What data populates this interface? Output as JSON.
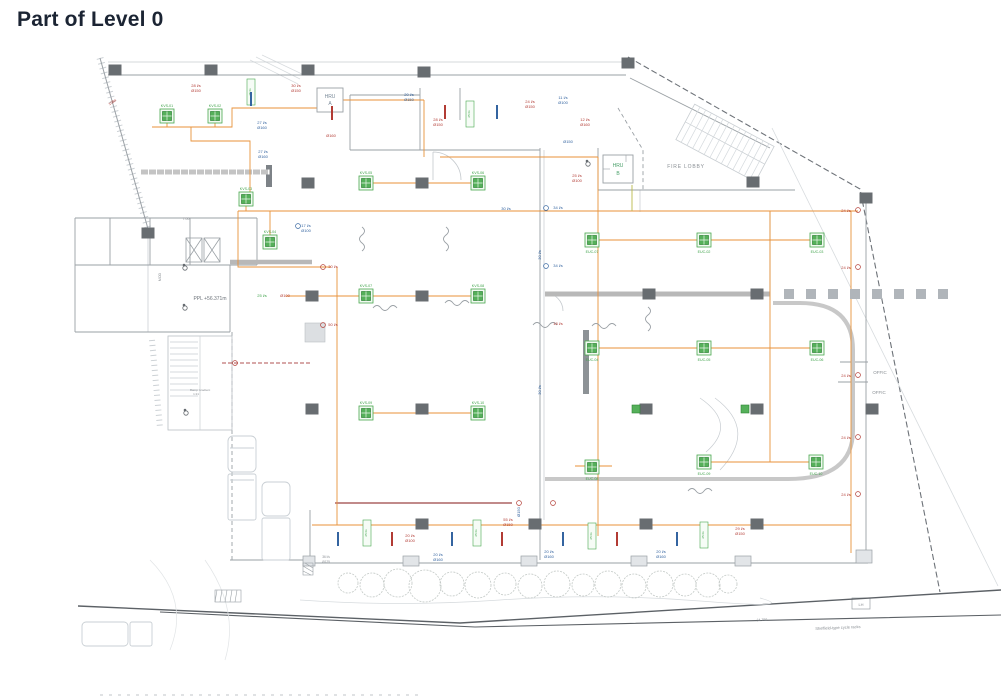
{
  "page": {
    "title": "Part of Level 0"
  },
  "colors": {
    "red": "#b23b34",
    "blue": "#3464a0",
    "green": "#3fa24a",
    "gray": "#8a8f94",
    "gray2": "#9aa0a5",
    "orange": "#e8923a",
    "hdr": "#7a8a99",
    "hdrb": "#4aa06a"
  },
  "plan": {
    "room_labels": [
      {
        "x": 330,
        "y": 98,
        "t": "HRU",
        "c": "hdr",
        "s": 5
      },
      {
        "x": 330,
        "y": 105,
        "t": "A",
        "c": "hdr",
        "s": 5
      },
      {
        "x": 618,
        "y": 167,
        "t": "HRU",
        "c": "hdrb",
        "s": 5
      },
      {
        "x": 618,
        "y": 175,
        "t": "B",
        "c": "hdrb",
        "s": 5
      },
      {
        "x": 686,
        "y": 168,
        "t": "FIRE LOBBY",
        "c": "gray",
        "s": 5,
        "ls": 0.8
      },
      {
        "x": 880,
        "y": 374,
        "t": "OFFIC",
        "c": "gray",
        "s": 4.5
      },
      {
        "x": 879,
        "y": 394,
        "t": "OFFIC",
        "c": "gray",
        "s": 4.5
      },
      {
        "x": 210,
        "y": 300,
        "t": "PPL +56.371m",
        "c": "#6d737a",
        "s": 5
      },
      {
        "x": 186,
        "y": 220,
        "t": "7.00",
        "c": "gray",
        "s": 3.5
      },
      {
        "x": 200,
        "y": 391,
        "t": "Ramp Gradient",
        "c": "gray",
        "s": 3
      },
      {
        "x": 196,
        "y": 395,
        "t": "1:21",
        "c": "gray",
        "s": 3
      },
      {
        "x": 161,
        "y": 277,
        "t": "MOD",
        "c": "gray",
        "s": 3.5,
        "r": -90
      },
      {
        "x": 762,
        "y": 621,
        "t": "34.750",
        "c": "gray",
        "s": 3.5,
        "r": -3
      },
      {
        "x": 838,
        "y": 629,
        "t": "Sheffield-type cycle racks",
        "c": "gray",
        "s": 4,
        "r": -2.5
      },
      {
        "x": 861,
        "y": 606,
        "t": "LH",
        "c": "gray",
        "s": 4
      }
    ],
    "flow_labels": [
      {
        "x": 113,
        "y": 103,
        "t": "10Ba",
        "c": "red",
        "s": 3.6,
        "r": -35
      },
      {
        "x": 196,
        "y": 87,
        "t": "28 l/s",
        "c": "red"
      },
      {
        "x": 196,
        "y": 92,
        "t": "Ø150",
        "c": "red"
      },
      {
        "x": 296,
        "y": 87,
        "t": "30 l/s",
        "c": "red"
      },
      {
        "x": 296,
        "y": 92,
        "t": "Ø150",
        "c": "red"
      },
      {
        "x": 262,
        "y": 124,
        "t": "27 l/s",
        "c": "blue"
      },
      {
        "x": 262,
        "y": 129,
        "t": "Ø160",
        "c": "blue"
      },
      {
        "x": 331,
        "y": 137,
        "t": "Ø160",
        "c": "red"
      },
      {
        "x": 263,
        "y": 153,
        "t": "27 l/s",
        "c": "blue"
      },
      {
        "x": 263,
        "y": 158,
        "t": "Ø160",
        "c": "blue"
      },
      {
        "x": 409,
        "y": 96,
        "t": "20 l/s",
        "c": "blue"
      },
      {
        "x": 409,
        "y": 101,
        "t": "Ø150",
        "c": "blue"
      },
      {
        "x": 438,
        "y": 121,
        "t": "28 l/s",
        "c": "red"
      },
      {
        "x": 438,
        "y": 126,
        "t": "Ø150",
        "c": "red"
      },
      {
        "x": 530,
        "y": 103,
        "t": "24 l/s",
        "c": "red"
      },
      {
        "x": 530,
        "y": 108,
        "t": "Ø150",
        "c": "red"
      },
      {
        "x": 563,
        "y": 99,
        "t": "11 l/s",
        "c": "blue"
      },
      {
        "x": 563,
        "y": 104,
        "t": "Ø100",
        "c": "blue"
      },
      {
        "x": 585,
        "y": 121,
        "t": "12 l/s",
        "c": "red"
      },
      {
        "x": 585,
        "y": 126,
        "t": "Ø160",
        "c": "red"
      },
      {
        "x": 568,
        "y": 143,
        "t": "Ø150",
        "c": "blue"
      },
      {
        "x": 577,
        "y": 177,
        "t": "25 l/s",
        "c": "red"
      },
      {
        "x": 577,
        "y": 182,
        "t": "Ø100",
        "c": "red"
      },
      {
        "x": 506,
        "y": 210,
        "t": "30 l/s",
        "c": "blue"
      },
      {
        "x": 558,
        "y": 209,
        "t": "34 l/s",
        "c": "blue"
      },
      {
        "x": 558,
        "y": 267,
        "t": "34 l/s",
        "c": "blue"
      },
      {
        "x": 558,
        "y": 325,
        "t": "18 l/s",
        "c": "red"
      },
      {
        "x": 306,
        "y": 227,
        "t": "17 l/s",
        "c": "blue"
      },
      {
        "x": 306,
        "y": 232,
        "t": "Ø100",
        "c": "blue"
      },
      {
        "x": 262,
        "y": 297,
        "t": "25 l/s",
        "c": "green"
      },
      {
        "x": 285,
        "y": 297,
        "t": "Ø100",
        "c": "red"
      },
      {
        "x": 333,
        "y": 268,
        "t": "30 l/s",
        "c": "red"
      },
      {
        "x": 333,
        "y": 326,
        "t": "50 l/s",
        "c": "red"
      },
      {
        "x": 846,
        "y": 212,
        "t": "24 l/s",
        "c": "red"
      },
      {
        "x": 846,
        "y": 269,
        "t": "24 l/s",
        "c": "red"
      },
      {
        "x": 846,
        "y": 377,
        "t": "24 l/s",
        "c": "red"
      },
      {
        "x": 846,
        "y": 439,
        "t": "24 l/s",
        "c": "red"
      },
      {
        "x": 846,
        "y": 496,
        "t": "24 l/s",
        "c": "red"
      },
      {
        "x": 410,
        "y": 537,
        "t": "20 l/s",
        "c": "red"
      },
      {
        "x": 410,
        "y": 542,
        "t": "Ø100",
        "c": "red"
      },
      {
        "x": 508,
        "y": 521,
        "t": "55 l/s",
        "c": "red"
      },
      {
        "x": 508,
        "y": 526,
        "t": "Ø150",
        "c": "red"
      },
      {
        "x": 740,
        "y": 530,
        "t": "29 l/s",
        "c": "red"
      },
      {
        "x": 740,
        "y": 535,
        "t": "Ø150",
        "c": "red"
      },
      {
        "x": 438,
        "y": 556,
        "t": "20 l/s",
        "c": "blue"
      },
      {
        "x": 438,
        "y": 561,
        "t": "Ø160",
        "c": "blue"
      },
      {
        "x": 549,
        "y": 553,
        "t": "20 l/s",
        "c": "blue"
      },
      {
        "x": 549,
        "y": 558,
        "t": "Ø160",
        "c": "blue"
      },
      {
        "x": 661,
        "y": 553,
        "t": "20 l/s",
        "c": "blue"
      },
      {
        "x": 661,
        "y": 558,
        "t": "Ø160",
        "c": "blue"
      },
      {
        "x": 326,
        "y": 558,
        "t": "36 l/s",
        "c": "gray",
        "s": 3.2
      },
      {
        "x": 326,
        "y": 563,
        "t": "Ø125",
        "c": "gray",
        "s": 3.2
      },
      {
        "x": 541,
        "y": 255,
        "t": "30 l/s",
        "c": "blue",
        "r": -90
      },
      {
        "x": 541,
        "y": 390,
        "t": "30 l/s",
        "c": "blue",
        "r": -90
      },
      {
        "x": 520,
        "y": 512,
        "t": "Ø150",
        "c": "blue",
        "r": -90
      }
    ],
    "units": [
      {
        "x": 167,
        "y": 116,
        "label": "KVS-01",
        "lp": "above"
      },
      {
        "x": 215,
        "y": 116,
        "label": "KVS-02",
        "lp": "above"
      },
      {
        "x": 246,
        "y": 199,
        "label": "KVS-03",
        "lp": "above"
      },
      {
        "x": 270,
        "y": 242,
        "label": "KVS-04",
        "lp": "above"
      },
      {
        "x": 366,
        "y": 183,
        "label": "KVS-05",
        "lp": "above"
      },
      {
        "x": 478,
        "y": 183,
        "label": "KVS-06",
        "lp": "above"
      },
      {
        "x": 366,
        "y": 296,
        "label": "KVS-07",
        "lp": "above"
      },
      {
        "x": 478,
        "y": 296,
        "label": "KVS-08",
        "lp": "above"
      },
      {
        "x": 366,
        "y": 413,
        "label": "KVS-09",
        "lp": "above"
      },
      {
        "x": 478,
        "y": 413,
        "label": "KVS-10",
        "lp": "above"
      },
      {
        "x": 592,
        "y": 240,
        "label": "EUC-07",
        "lp": "below"
      },
      {
        "x": 704,
        "y": 240,
        "label": "EUC-02",
        "lp": "below"
      },
      {
        "x": 817,
        "y": 240,
        "label": "EUC-03",
        "lp": "below"
      },
      {
        "x": 592,
        "y": 348,
        "label": "EUC-04",
        "lp": "below"
      },
      {
        "x": 704,
        "y": 348,
        "label": "EUC-05",
        "lp": "below"
      },
      {
        "x": 817,
        "y": 348,
        "label": "EUC-06",
        "lp": "below"
      },
      {
        "x": 592,
        "y": 467,
        "label": "EUC-08",
        "lp": "below"
      },
      {
        "x": 704,
        "y": 462,
        "label": "EUC-09",
        "lp": "below"
      },
      {
        "x": 816,
        "y": 462,
        "label": "EUC-10",
        "lp": "below"
      }
    ],
    "mini_units": [
      {
        "x": 636,
        "y": 409
      },
      {
        "x": 745,
        "y": 409
      }
    ],
    "vlabels": [
      {
        "x": 251,
        "y": 92,
        "t": "25 l/s"
      },
      {
        "x": 470,
        "y": 114,
        "t": "25 l/s"
      },
      {
        "x": 367,
        "y": 533,
        "t": "25 l/s"
      },
      {
        "x": 477,
        "y": 533,
        "t": "25 l/s"
      },
      {
        "x": 592,
        "y": 536,
        "t": "25 l/s"
      },
      {
        "x": 704,
        "y": 535,
        "t": "25 l/s"
      }
    ],
    "columns": [
      [
        115,
        70
      ],
      [
        211,
        70
      ],
      [
        308,
        70
      ],
      [
        424,
        72
      ],
      [
        628,
        63
      ],
      [
        308,
        183
      ],
      [
        422,
        183
      ],
      [
        312,
        296
      ],
      [
        422,
        296
      ],
      [
        649,
        294
      ],
      [
        757,
        294
      ],
      [
        312,
        409
      ],
      [
        422,
        409
      ],
      [
        646,
        409
      ],
      [
        757,
        409
      ],
      [
        422,
        524
      ],
      [
        535,
        524
      ],
      [
        646,
        524
      ],
      [
        757,
        524
      ],
      [
        753,
        182
      ],
      [
        872,
        409
      ],
      [
        866,
        198
      ],
      [
        148,
        233
      ]
    ],
    "ticks": {
      "blue": [
        [
          338,
          539
        ],
        [
          452,
          539
        ],
        [
          563,
          539
        ],
        [
          677,
          539
        ],
        [
          251,
          99
        ],
        [
          497,
          112
        ]
      ],
      "red": [
        [
          392,
          539
        ],
        [
          502,
          539
        ],
        [
          617,
          539
        ],
        [
          332,
          113
        ],
        [
          445,
          112
        ]
      ]
    },
    "symbols": {
      "red_circles": [
        [
          323,
          267
        ],
        [
          323,
          325
        ],
        [
          858,
          210
        ],
        [
          858,
          267
        ],
        [
          858,
          375
        ],
        [
          858,
          437
        ],
        [
          858,
          494
        ],
        [
          235,
          363
        ],
        [
          519,
          503
        ],
        [
          553,
          503
        ]
      ],
      "blue_circles": [
        [
          546,
          208
        ],
        [
          546,
          266
        ],
        [
          298,
          226
        ]
      ]
    },
    "squiggles": [
      {
        "x": 362,
        "y": 227,
        "o": "v"
      },
      {
        "x": 446,
        "y": 227,
        "o": "v"
      },
      {
        "x": 648,
        "y": 307,
        "o": "v"
      },
      {
        "x": 373,
        "y": 308,
        "o": "h"
      },
      {
        "x": 445,
        "y": 303,
        "o": "h"
      },
      {
        "x": 592,
        "y": 326,
        "o": "h"
      },
      {
        "x": 688,
        "y": 491,
        "o": "h"
      },
      {
        "x": 533,
        "y": 325,
        "o": "h"
      }
    ],
    "trees": [
      [
        348,
        583,
        10
      ],
      [
        372,
        585,
        12
      ],
      [
        398,
        583,
        14
      ],
      [
        425,
        586,
        16
      ],
      [
        452,
        584,
        12
      ],
      [
        478,
        585,
        13
      ],
      [
        505,
        584,
        11
      ],
      [
        530,
        586,
        12
      ],
      [
        557,
        584,
        13
      ],
      [
        583,
        585,
        11
      ],
      [
        608,
        584,
        13
      ],
      [
        634,
        586,
        12
      ],
      [
        660,
        584,
        13
      ],
      [
        685,
        585,
        11
      ],
      [
        708,
        585,
        12
      ],
      [
        728,
        584,
        9
      ]
    ],
    "grille_x": [
      784,
      806,
      828,
      850,
      872,
      894,
      916,
      938
    ]
  }
}
